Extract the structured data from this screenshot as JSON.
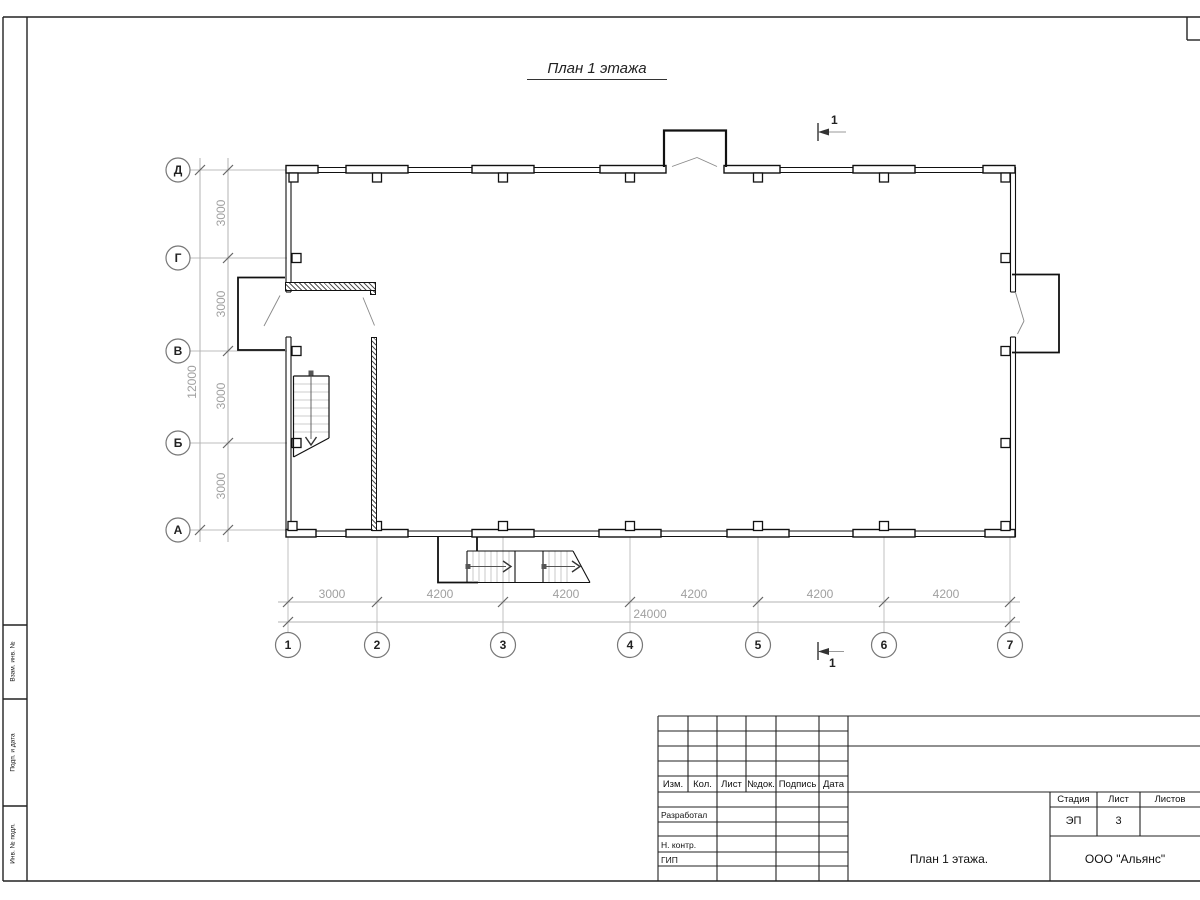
{
  "sheet": {
    "title": "План 1 этажа"
  },
  "axes": {
    "rows": [
      {
        "label": "Д"
      },
      {
        "label": "Г"
      },
      {
        "label": "В"
      },
      {
        "label": "Б"
      },
      {
        "label": "А"
      }
    ],
    "cols": [
      {
        "label": "1"
      },
      {
        "label": "2"
      },
      {
        "label": "3"
      },
      {
        "label": "4"
      },
      {
        "label": "5"
      },
      {
        "label": "6"
      },
      {
        "label": "7"
      }
    ]
  },
  "dims": {
    "v_seg": [
      "3000",
      "3000",
      "3000",
      "3000"
    ],
    "v_total": "12000",
    "h_seg": [
      "3000",
      "4200",
      "4200",
      "4200",
      "4200",
      "4200"
    ],
    "h_total": "24000"
  },
  "section": {
    "top": "1",
    "bottom": "1"
  },
  "frame_strip": {
    "labels": [
      "Взам. инв. №",
      "Подп. и дата",
      "Инв. № подл."
    ]
  },
  "title_block": {
    "header": [
      "Изм.",
      "Кол.",
      "Лист",
      "№док.",
      "Подпись",
      "Дата"
    ],
    "roles": [
      "Разработал",
      "Н. контр.",
      "ГИП"
    ],
    "stage_label": "Стадия",
    "sheet_label": "Лист",
    "sheets_label": "Листов",
    "stage": "ЭП",
    "sheet_no": "3",
    "doc_name": "План 1 этажа.",
    "company": "ООО \"Альянс\""
  }
}
